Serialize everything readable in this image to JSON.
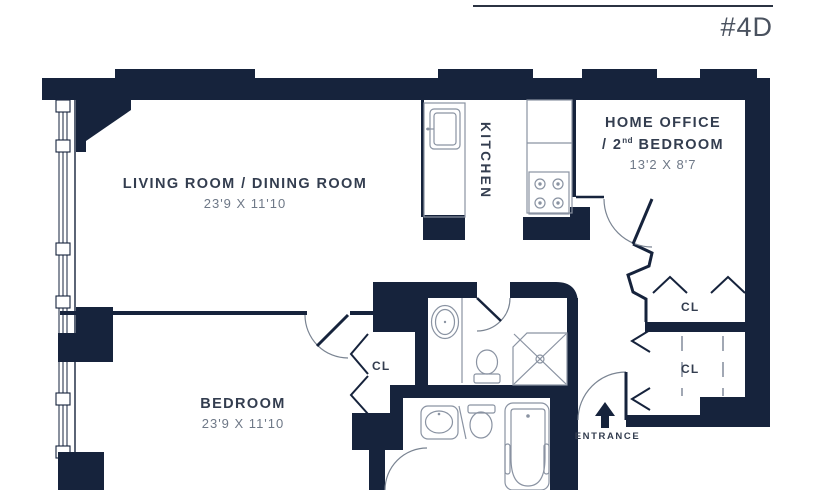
{
  "title": {
    "unit_label": "#4D"
  },
  "rooms": {
    "living": {
      "name": "LIVING ROOM / DINING ROOM",
      "dimensions": "23'9 X 11'10"
    },
    "kitchen": {
      "name": "KITCHEN"
    },
    "home_office": {
      "name_line1": "HOME OFFICE",
      "name_line2_prefix": "/ 2",
      "name_line2_sup": "nd",
      "name_line2_suffix": " BEDROOM",
      "dimensions": "13'2 X 8'7"
    },
    "bedroom": {
      "name": "BEDROOM",
      "dimensions": "23'9 X 11'10"
    }
  },
  "closets": {
    "bedroom_closet_label": "CL",
    "office_closet_label": "CL",
    "hall_closet_label": "CL"
  },
  "entrance": {
    "label": "ENTRANCE"
  },
  "colors": {
    "wall": "#16233C",
    "label": "#333D4F",
    "dimension": "#6E7887",
    "fixture": "#8A93A2",
    "background": "#FFFFFF"
  }
}
